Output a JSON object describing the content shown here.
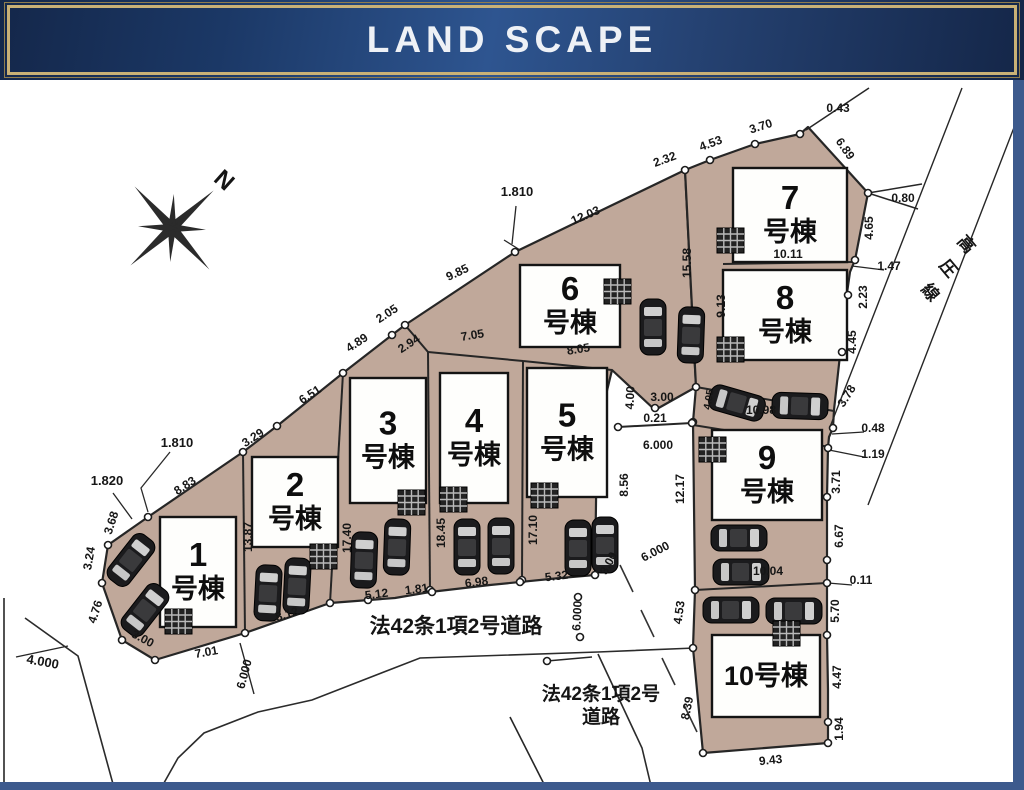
{
  "banner": {
    "title": "LAND SCAPE"
  },
  "compass": {
    "label": "N"
  },
  "colors": {
    "parcel_tan": "#c0a89a",
    "banner_navy": "#1b3866",
    "banner_gold": "#c9b176",
    "frame_blue": "#3d5a8d",
    "line_ink": "#262626"
  },
  "plan": {
    "buildings": [
      {
        "id": 1,
        "x": 160,
        "y": 517,
        "w": 76,
        "h": 110,
        "num": "1",
        "sub": "号棟"
      },
      {
        "id": 2,
        "x": 252,
        "y": 457,
        "w": 86,
        "h": 90,
        "num": "2",
        "sub": "号棟"
      },
      {
        "id": 3,
        "x": 350,
        "y": 378,
        "w": 76,
        "h": 125,
        "num": "3",
        "sub": "号棟"
      },
      {
        "id": 4,
        "x": 440,
        "y": 373,
        "w": 68,
        "h": 130,
        "num": "4",
        "sub": "号棟"
      },
      {
        "id": 5,
        "x": 527,
        "y": 368,
        "w": 80,
        "h": 129,
        "num": "5",
        "sub": "号棟"
      },
      {
        "id": 6,
        "x": 520,
        "y": 265,
        "w": 100,
        "h": 82,
        "num": "6",
        "sub": "号棟"
      },
      {
        "id": 7,
        "x": 733,
        "y": 168,
        "w": 114,
        "h": 94,
        "num": "7",
        "sub": "号棟"
      },
      {
        "id": 8,
        "x": 723,
        "y": 270,
        "w": 124,
        "h": 90,
        "num": "8",
        "sub": "号棟"
      },
      {
        "id": 9,
        "x": 712,
        "y": 430,
        "w": 110,
        "h": 90,
        "num": "9",
        "sub": "号棟"
      },
      {
        "id": 10,
        "x": 712,
        "y": 635,
        "w": 108,
        "h": 82,
        "num": "10号棟",
        "sub": null
      }
    ],
    "dim_labels": [
      {
        "t": "8.83",
        "x": 187,
        "y": 489,
        "r": -33
      },
      {
        "t": "3.29",
        "x": 255,
        "y": 441,
        "r": -33
      },
      {
        "t": "6.51",
        "x": 312,
        "y": 398,
        "r": -33
      },
      {
        "t": "4.89",
        "x": 359,
        "y": 346,
        "r": -33
      },
      {
        "t": "2.05",
        "x": 389,
        "y": 317,
        "r": -33
      },
      {
        "t": "9.85",
        "x": 459,
        "y": 276,
        "r": -25
      },
      {
        "t": "12.03",
        "x": 587,
        "y": 219,
        "r": -23
      },
      {
        "t": "2.32",
        "x": 666,
        "y": 163,
        "r": -20
      },
      {
        "t": "4.53",
        "x": 712,
        "y": 147,
        "r": -20
      },
      {
        "t": "3.70",
        "x": 762,
        "y": 130,
        "r": -18
      },
      {
        "t": "0.43",
        "x": 838,
        "y": 112,
        "r": 0
      },
      {
        "t": "6.89",
        "x": 842,
        "y": 151,
        "r": 55
      },
      {
        "t": "1.810",
        "x": 517,
        "y": 196,
        "r": 0,
        "s": 13
      },
      {
        "t": "1.810",
        "x": 177,
        "y": 447,
        "r": 0,
        "s": 13
      },
      {
        "t": "1.820",
        "x": 107,
        "y": 485,
        "r": 0,
        "s": 13
      },
      {
        "t": "3.68",
        "x": 115,
        "y": 524,
        "r": -72
      },
      {
        "t": "3.24",
        "x": 93,
        "y": 559,
        "r": -80
      },
      {
        "t": "4.76",
        "x": 99,
        "y": 613,
        "r": -72
      },
      {
        "t": "3.00",
        "x": 141,
        "y": 642,
        "r": 28
      },
      {
        "t": "4.000",
        "x": 42,
        "y": 666,
        "r": 10,
        "s": 13
      },
      {
        "t": "7.01",
        "x": 207,
        "y": 656,
        "r": -10
      },
      {
        "t": "6.000",
        "x": 248,
        "y": 675,
        "r": -75
      },
      {
        "t": "8.12",
        "x": 288,
        "y": 618,
        "r": -17
      },
      {
        "t": "5.12",
        "x": 377,
        "y": 598,
        "r": -7
      },
      {
        "t": "1.81",
        "x": 417,
        "y": 593,
        "r": -7
      },
      {
        "t": "6.98",
        "x": 477,
        "y": 586,
        "r": -7
      },
      {
        "t": "5.32",
        "x": 557,
        "y": 580,
        "r": -7
      },
      {
        "t": "6.000",
        "x": 581,
        "y": 616,
        "r": -87
      },
      {
        "t": "13.87",
        "x": 252,
        "y": 537,
        "r": -90
      },
      {
        "t": "17.40",
        "x": 351,
        "y": 538,
        "r": -90
      },
      {
        "t": "18.45",
        "x": 445,
        "y": 533,
        "r": -90
      },
      {
        "t": "17.10",
        "x": 537,
        "y": 530,
        "r": -90
      },
      {
        "t": "15.58",
        "x": 691,
        "y": 263,
        "r": -90
      },
      {
        "t": "9.13",
        "x": 725,
        "y": 306,
        "r": -90
      },
      {
        "t": "2.94",
        "x": 411,
        "y": 347,
        "r": -33
      },
      {
        "t": "7.05",
        "x": 473,
        "y": 339,
        "r": -9
      },
      {
        "t": "8.05",
        "x": 579,
        "y": 353,
        "r": -9
      },
      {
        "t": "10.11",
        "x": 788,
        "y": 258,
        "r": 0
      },
      {
        "t": "0.80",
        "x": 903,
        "y": 202,
        "r": 0
      },
      {
        "t": "4.65",
        "x": 873,
        "y": 228,
        "r": -90
      },
      {
        "t": "1.47",
        "x": 889,
        "y": 270,
        "r": 0
      },
      {
        "t": "2.23",
        "x": 867,
        "y": 297,
        "r": -90
      },
      {
        "t": "4.45",
        "x": 856,
        "y": 342,
        "r": -90
      },
      {
        "t": "3.78",
        "x": 850,
        "y": 398,
        "r": -58
      },
      {
        "t": "0.48",
        "x": 873,
        "y": 432,
        "r": 0
      },
      {
        "t": "1.19",
        "x": 873,
        "y": 458,
        "r": 0
      },
      {
        "t": "3.71",
        "x": 840,
        "y": 482,
        "r": -90
      },
      {
        "t": "6.67",
        "x": 843,
        "y": 536,
        "r": -90
      },
      {
        "t": "0.11",
        "x": 861,
        "y": 584,
        "r": 0
      },
      {
        "t": "5.70",
        "x": 839,
        "y": 611,
        "r": -90
      },
      {
        "t": "4.47",
        "x": 841,
        "y": 677,
        "r": -90
      },
      {
        "t": "1.94",
        "x": 843,
        "y": 729,
        "r": -90
      },
      {
        "t": "9.43",
        "x": 771,
        "y": 764,
        "r": -6
      },
      {
        "t": "8.39",
        "x": 691,
        "y": 709,
        "r": -78
      },
      {
        "t": "4.53",
        "x": 683,
        "y": 613,
        "r": -82
      },
      {
        "t": "4.00",
        "x": 634,
        "y": 398,
        "r": -87
      },
      {
        "t": "3.00",
        "x": 662,
        "y": 401,
        "r": 0
      },
      {
        "t": "0.21",
        "x": 655,
        "y": 422,
        "r": 0
      },
      {
        "t": "6.000",
        "x": 658,
        "y": 449,
        "r": 0
      },
      {
        "t": "8.56",
        "x": 628,
        "y": 485,
        "r": -90
      },
      {
        "t": "12.17",
        "x": 684,
        "y": 489,
        "r": -90
      },
      {
        "t": "6.000",
        "x": 657,
        "y": 555,
        "r": -27
      },
      {
        "t": "3.00",
        "x": 612,
        "y": 565,
        "r": -62
      },
      {
        "t": "10.98",
        "x": 761,
        "y": 414,
        "r": 0
      },
      {
        "t": "4.05",
        "x": 712,
        "y": 400,
        "r": -80,
        "s": 10.5
      },
      {
        "t": "10.04",
        "x": 768,
        "y": 575,
        "r": 0
      }
    ],
    "annotations": [
      {
        "t": "法42条1項2号道路",
        "x": 456,
        "y": 633,
        "r": 0,
        "s": 21,
        "w": 700
      },
      {
        "t": "法42条1項2号",
        "x": 601,
        "y": 700,
        "r": 0,
        "s": 19,
        "w": 700
      },
      {
        "t": "道路",
        "x": 601,
        "y": 723,
        "r": 0,
        "s": 19,
        "w": 700
      },
      {
        "t": "高",
        "x": 962,
        "y": 248,
        "r": 50,
        "s": 17,
        "w": 700
      },
      {
        "t": "圧",
        "x": 944,
        "y": 272,
        "r": 50,
        "s": 17,
        "w": 700
      },
      {
        "t": "線",
        "x": 926,
        "y": 296,
        "r": 50,
        "s": 17,
        "w": 700
      }
    ],
    "parcels": {
      "a": "108,545 148,517 243,452 277,426 343,373 392,335 405,325 515,252 685,170 696,387 655,410 612,370 597,432 595,575 560,578 490,585 430,592 395,598 330,603 245,633 155,660 122,640 102,583",
      "b": "685,170 710,160 755,144 800,134 808,127 868,193 855,260 850,272 846,300 840,355 834,410 833,428 829,437 828,448 827,497 827,560 827,583 827,635 828,690 828,722 828,743 703,753 693,648 695,590 693,422 696,387"
    },
    "inner_lines": [
      [
        243,
        452,
        245,
        633,
        2
      ],
      [
        343,
        373,
        330,
        603,
        2
      ],
      [
        405,
        325,
        428,
        352,
        2
      ],
      [
        428,
        352,
        430,
        590,
        2
      ],
      [
        428,
        352,
        523,
        361,
        2
      ],
      [
        523,
        361,
        522,
        580,
        2
      ],
      [
        523,
        361,
        612,
        370,
        2
      ],
      [
        618,
        427,
        692,
        423,
        2
      ],
      [
        723,
        264,
        852,
        262,
        2
      ],
      [
        696,
        387,
        834,
        411,
        2
      ],
      [
        693,
        425,
        830,
        447,
        2
      ],
      [
        695,
        590,
        827,
        583,
        2
      ]
    ],
    "thin_lines": [
      [
        806,
        130,
        869,
        88,
        1.5
      ],
      [
        868,
        193,
        922,
        184,
        1.5
      ],
      [
        868,
        193,
        918,
        209,
        1.5
      ],
      [
        852,
        266,
        884,
        270,
        1.2
      ],
      [
        832,
        434,
        864,
        432,
        1.2
      ],
      [
        829,
        450,
        864,
        457,
        1.2
      ],
      [
        828,
        583,
        852,
        585,
        1.2
      ],
      [
        516,
        206,
        512,
        244,
        1.3
      ],
      [
        504,
        240,
        520,
        250,
        1.3
      ],
      [
        113,
        493,
        132,
        519,
        1.3
      ],
      [
        16,
        657,
        68,
        646,
        1.4
      ],
      [
        240,
        643,
        254,
        694,
        1.4
      ],
      [
        547,
        661,
        592,
        657,
        1.4
      ],
      [
        962,
        88,
        830,
        427,
        1.4
      ],
      [
        1020,
        112,
        868,
        505,
        1.4
      ],
      [
        510,
        717,
        547,
        790,
        1.6
      ],
      [
        4,
        598,
        4,
        788,
        1.6
      ]
    ],
    "polylines": [
      {
        "p": "25,618 78,656 113,784",
        "w": 1.6
      },
      {
        "p": "160,790 178,758 204,733 258,712 312,700 420,658 598,652 695,648",
        "w": 1.6
      },
      {
        "p": "598,654 642,748 652,790",
        "w": 1.6
      },
      {
        "p": "170,452 141,488 148,512",
        "w": 1.3
      }
    ],
    "dashes": [
      [
        620,
        565,
        633,
        592
      ],
      [
        641,
        610,
        654,
        637
      ],
      [
        662,
        658,
        675,
        685
      ],
      [
        684,
        705,
        697,
        732
      ],
      [
        745,
        672,
        759,
        698
      ],
      [
        777,
        622,
        790,
        648
      ]
    ],
    "slashes": [
      [
        727,
        449,
        741,
        437
      ],
      [
        757,
        470,
        773,
        456
      ],
      [
        791,
        453,
        805,
        441
      ],
      [
        737,
        496,
        751,
        483
      ],
      [
        772,
        506,
        789,
        492
      ]
    ],
    "circles": [
      [
        148,
        517
      ],
      [
        243,
        452
      ],
      [
        277,
        426
      ],
      [
        343,
        373
      ],
      [
        392,
        335
      ],
      [
        405,
        325
      ],
      [
        515,
        252
      ],
      [
        685,
        170
      ],
      [
        710,
        160
      ],
      [
        755,
        144
      ],
      [
        800,
        134
      ],
      [
        868,
        193
      ],
      [
        855,
        260
      ],
      [
        848,
        295
      ],
      [
        842,
        352
      ],
      [
        833,
        428
      ],
      [
        828,
        448
      ],
      [
        827,
        497
      ],
      [
        827,
        560
      ],
      [
        827,
        583
      ],
      [
        827,
        635
      ],
      [
        828,
        722
      ],
      [
        828,
        743
      ],
      [
        703,
        753
      ],
      [
        693,
        648
      ],
      [
        695,
        590
      ],
      [
        693,
        422
      ],
      [
        696,
        387
      ],
      [
        108,
        545
      ],
      [
        102,
        583
      ],
      [
        122,
        640
      ],
      [
        155,
        660
      ],
      [
        245,
        633
      ],
      [
        330,
        603
      ],
      [
        430,
        590
      ],
      [
        522,
        580
      ],
      [
        595,
        575
      ],
      [
        368,
        600
      ],
      [
        432,
        592
      ],
      [
        520,
        582
      ],
      [
        655,
        408
      ],
      [
        618,
        427
      ],
      [
        692,
        423
      ],
      [
        578,
        597
      ],
      [
        580,
        637
      ],
      [
        547,
        661
      ]
    ],
    "cars": [
      [
        131,
        560,
        38
      ],
      [
        145,
        610,
        38
      ],
      [
        268,
        593,
        3
      ],
      [
        297,
        586,
        3
      ],
      [
        364,
        560,
        2
      ],
      [
        397,
        547,
        2
      ],
      [
        467,
        547,
        0
      ],
      [
        501,
        546,
        0
      ],
      [
        578,
        548,
        0
      ],
      [
        605,
        545,
        0
      ],
      [
        653,
        327,
        0
      ],
      [
        691,
        335,
        2
      ],
      [
        737,
        403,
        106
      ],
      [
        800,
        406,
        92
      ],
      [
        739,
        538,
        90
      ],
      [
        741,
        572,
        90
      ],
      [
        731,
        610,
        90
      ],
      [
        794,
        611,
        90
      ]
    ],
    "hatches": [
      [
        165,
        609
      ],
      [
        310,
        544
      ],
      [
        398,
        490
      ],
      [
        440,
        487
      ],
      [
        531,
        483
      ],
      [
        604,
        279
      ],
      [
        717,
        228
      ],
      [
        717,
        337
      ],
      [
        699,
        437
      ],
      [
        773,
        621
      ]
    ]
  }
}
